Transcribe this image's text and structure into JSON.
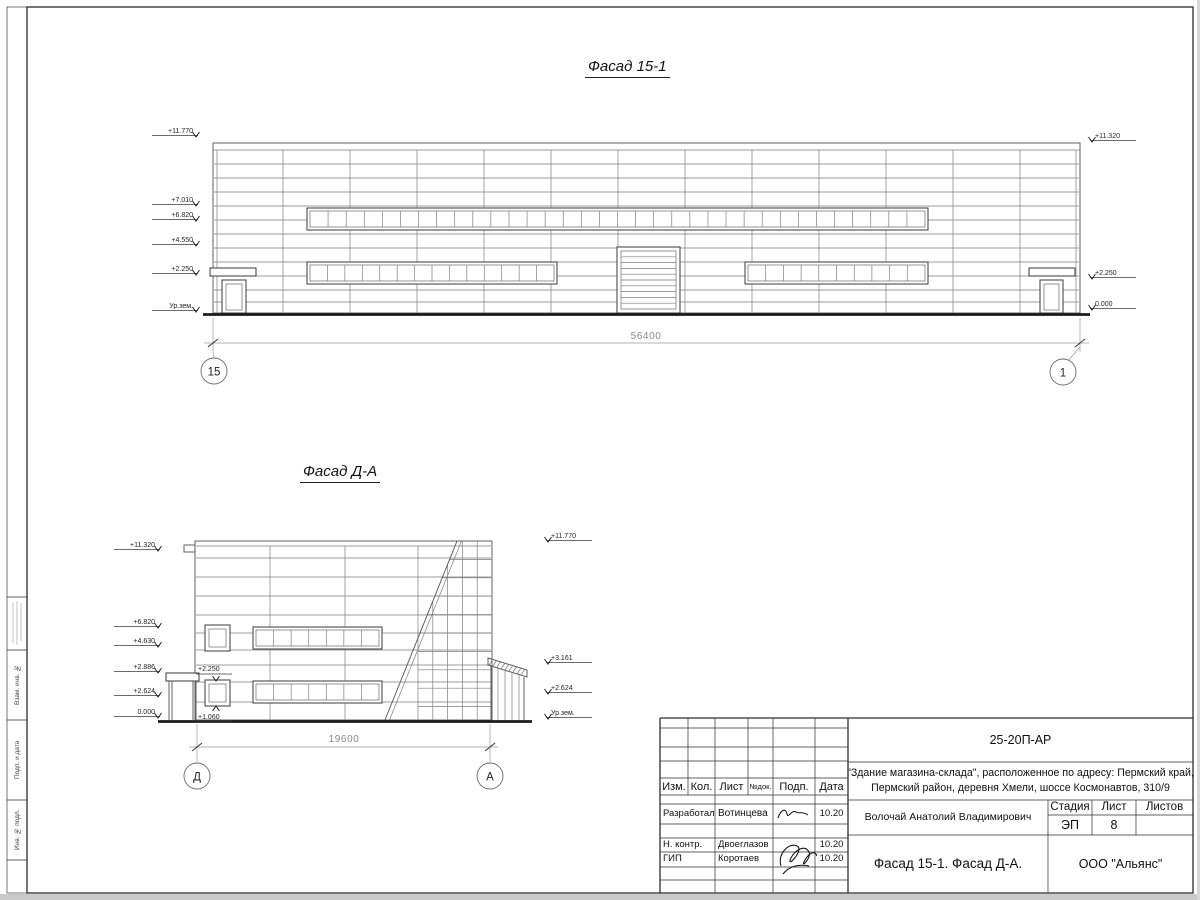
{
  "facade1": {
    "title": "Фасад 15-1",
    "dimension": "56400",
    "axis_left": "15",
    "axis_right": "1",
    "marks_left": [
      "+11.770",
      "+7.010",
      "+6.820",
      "+4.550",
      "+2.250",
      "Ур.зем."
    ],
    "marks_right": [
      "+11.320",
      "+2.250",
      "0.000"
    ]
  },
  "facade2": {
    "title": "Фасад Д-А",
    "dimension": "19600",
    "axis_left": "Д",
    "axis_right": "А",
    "marks_left": [
      "+11.320",
      "+6.820",
      "+4.630",
      "+2.886",
      "+2.624",
      "0.000"
    ],
    "marks_right": [
      "+11.770",
      "+3.161",
      "+2.624",
      "Ур.зем."
    ],
    "marks_inner": [
      "+2.250",
      "+1.060"
    ]
  },
  "titleblock": {
    "code": "25-20П-АР",
    "object_line1": "\"Здание магазина-склада\", расположенное по адресу: Пермский край,",
    "object_line2": "Пермский район, деревня Хмели, шоссе Космонавтов, 310/9",
    "columns": {
      "izm": "Изм.",
      "kol": "Кол.",
      "list": "Лист",
      "ndok": "№док.",
      "podp": "Подп.",
      "data": "Дата"
    },
    "rows": [
      {
        "role": "Разработал",
        "name": "Вотинцева",
        "date": "10.20"
      },
      {
        "role": "Н. контр.",
        "name": "Двоеглазов",
        "date": "10.20"
      },
      {
        "role": "ГИП",
        "name": "Коротаев",
        "date": "10.20"
      }
    ],
    "approver": "Волочай Анатолий Владимирович",
    "sheet_title": "Фасад 15-1. Фасад Д-А.",
    "company": "ООО \"Альянс\"",
    "stage_label": "Стадия",
    "list_label": "Лист",
    "listov_label": "Листов",
    "stage": "ЭП",
    "sheet_number": "8"
  },
  "frame": {
    "side_labels": [
      "Взам. инв. №",
      "Подп. и дата",
      "Инв. № подл."
    ]
  }
}
